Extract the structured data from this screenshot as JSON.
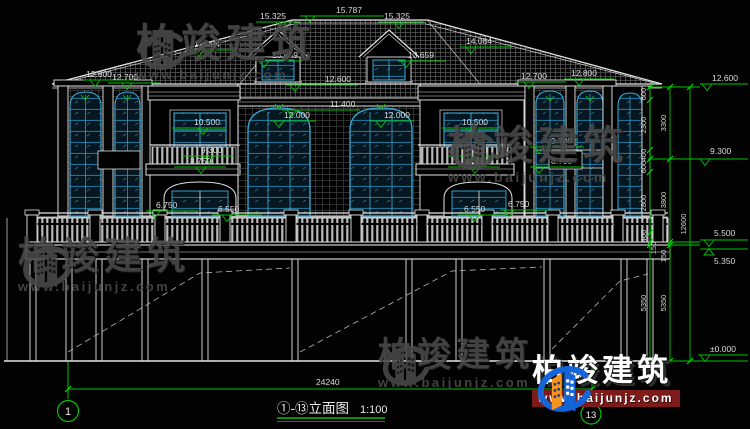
{
  "drawing": {
    "title": "①-⑬立面图",
    "scale": "1:100",
    "bottom_dim_total": "24240",
    "grid_bubble_left": "1",
    "grid_bubble_right": "13"
  },
  "levels": {
    "ridge": "15.787",
    "dormer_peak_left": "15.325",
    "dormer_peak_right": "15.325",
    "hip_left": "14.084",
    "hip_right": "14.084",
    "dormer_sill_left": "13.659",
    "dormer_sill_right": "13.659",
    "eave_left_outer": "12.800",
    "eave_left_inner": "12.700",
    "eave_center": "12.600",
    "arch_mid": "11.400",
    "arch_left": "12.000",
    "arch_right": "12.000",
    "win_left": "10.500",
    "win_right": "10.500",
    "rail_top_left": "9.300",
    "slab_left": "8.750",
    "rail_top_right": "9.300",
    "slab_right": "8.750",
    "bay_right_top": "9.700",
    "bay_right_mid": "8.700",
    "door_left": "6.750",
    "deck_left": "6.550",
    "deck_right": "6.550",
    "door_right": "6.750",
    "eave_right_inner": "12.700",
    "eave_right_outer": "12.800",
    "right_eave": "12.600",
    "right_mid": "9.300",
    "right_deck_top": "5.500",
    "right_deck_bot": "5.350",
    "right_ground": "±0.000"
  },
  "chains": {
    "col1": [
      "600",
      "2300",
      "400",
      "600",
      "2800",
      "400",
      "150",
      "5350"
    ],
    "col2": [
      "3300",
      "3800",
      "150",
      "5350"
    ],
    "total": "12600"
  },
  "watermark": {
    "brand": "柏竣建筑",
    "url": "www.baijunjz.com"
  },
  "logo_colors": {
    "blue": "#1565d8",
    "orange": "#f7941d",
    "bar_red": "#7d1b1b"
  }
}
